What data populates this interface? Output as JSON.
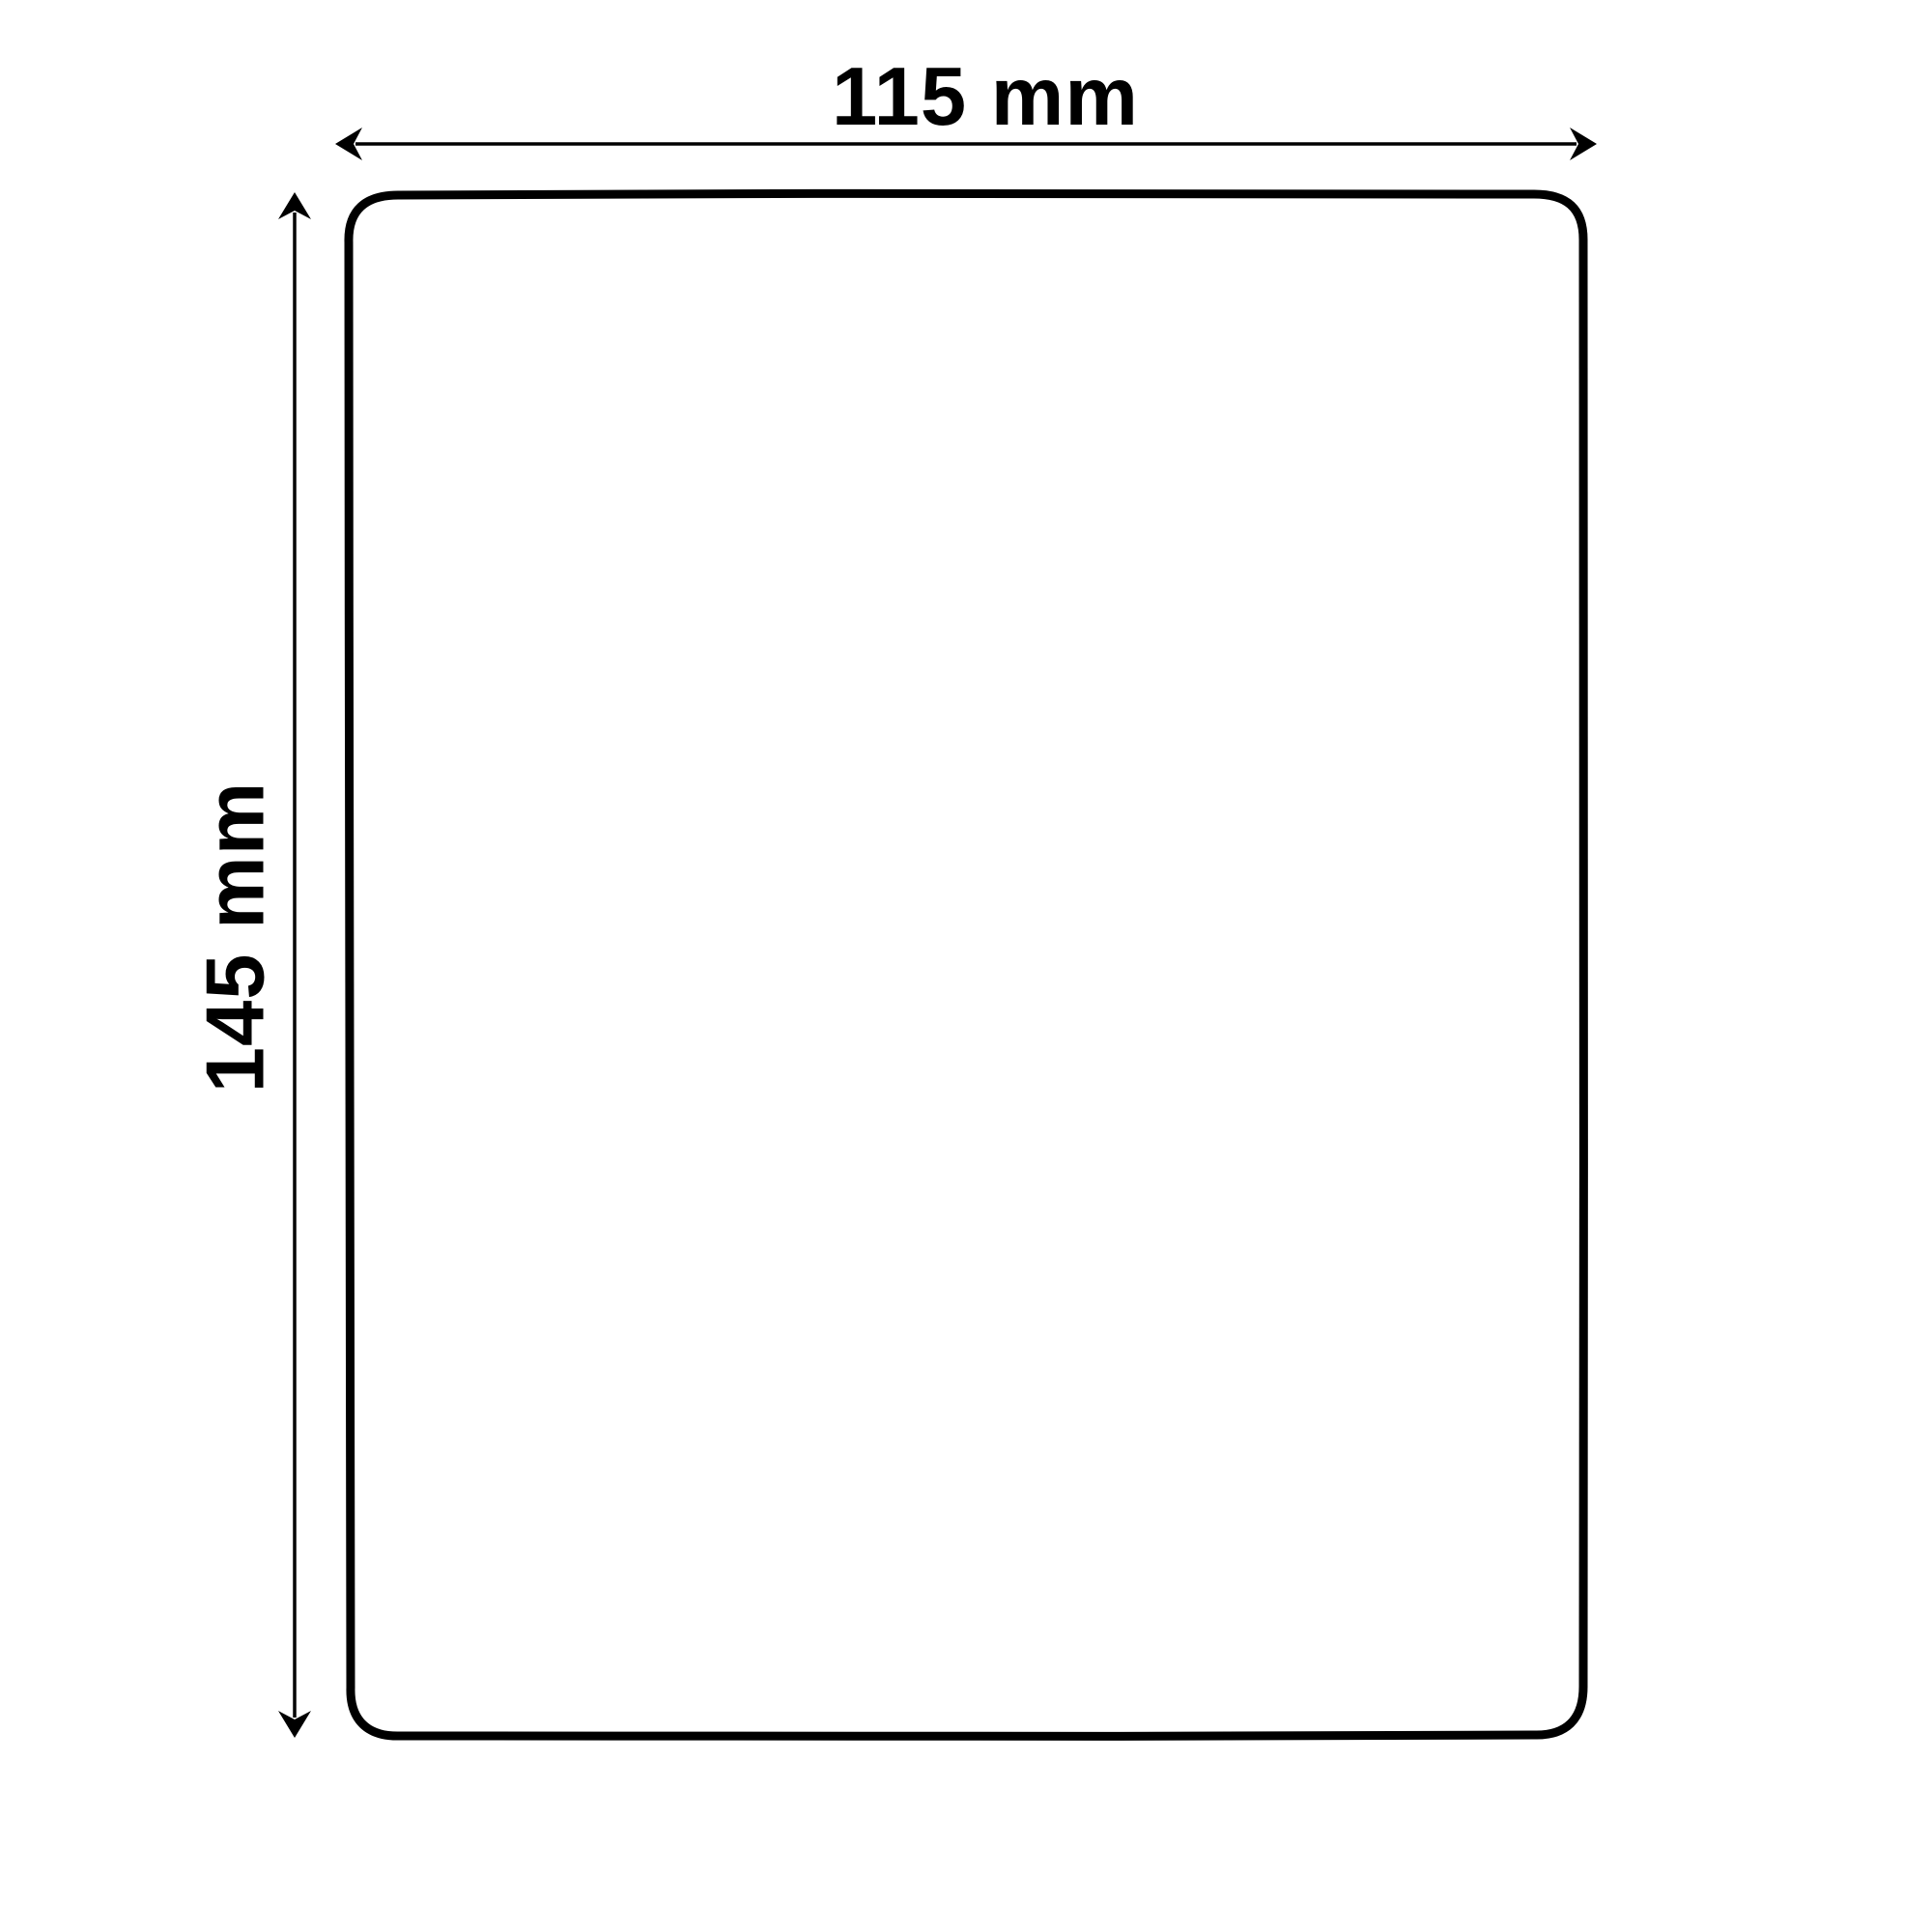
{
  "diagram": {
    "type": "product-dimension-diagram",
    "shape": "rounded-rectangle",
    "width_label": "115 mm",
    "height_label": "145 mm",
    "width_value_mm": 115,
    "height_value_mm": 145,
    "unit": "mm",
    "colors": {
      "background": "#ffffff",
      "line": "#000000",
      "text": "#000000"
    },
    "icons": {
      "width_arrow": "horizontal-double-arrow",
      "height_arrow": "vertical-double-arrow"
    }
  }
}
